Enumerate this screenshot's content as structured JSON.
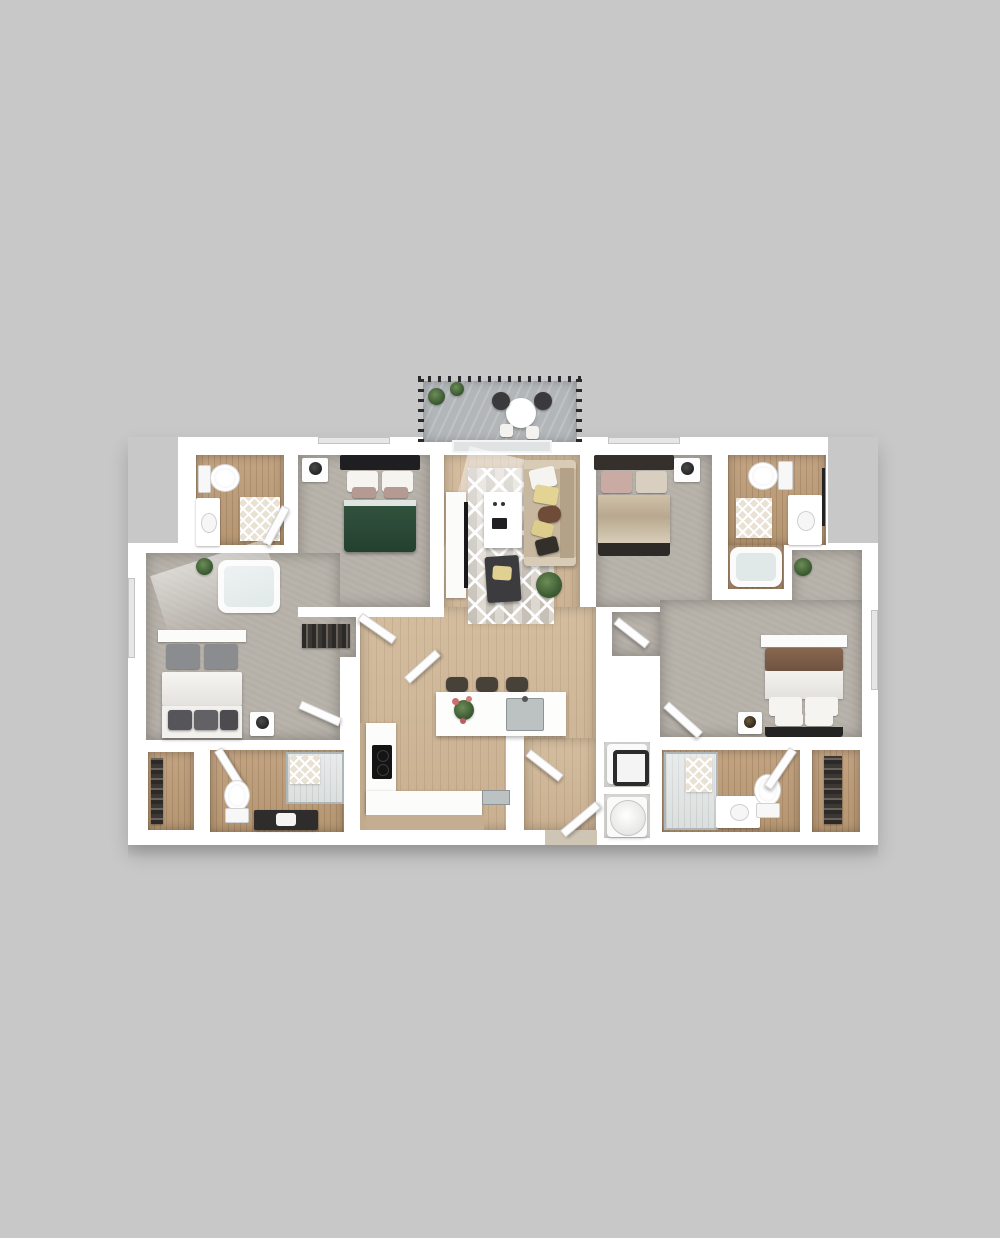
{
  "scene": {
    "type": "3d-floor-plan-render",
    "description": "Top-down 3D architectural rendering of a four-bedroom, four-bathroom apartment floor plan with a central living room and kitchen, a top balcony with patio furniture, and a stacked washer/dryer closet. No text labels are present in the image.",
    "background_color": "#c8c8c8",
    "wall_color": "#ffffff"
  },
  "palette": {
    "background": "#c8c8c8",
    "walls": "#ffffff",
    "carpet": "#b4afa7",
    "wood_light": "#cdb698",
    "wood_bath": "#bc9d7c",
    "balcony_deck": "#b2b6b9",
    "railing": "#2b2b2d",
    "bed_green": "#2c4b3c",
    "bed_tan": "#d3c7b2",
    "blanket_brown": "#7c5c49",
    "sofa_tan": "#c7b89f",
    "accent_yellow": "#e3d494",
    "charcoal": "#2a2a2c",
    "plant_green": "#3f6136",
    "steel": "#bcc1c2"
  },
  "rooms": [
    {
      "name": "balcony",
      "floor": "gray deck planks",
      "furniture": [
        "round patio table",
        "two dark chairs",
        "two white stools",
        "two potted plants",
        "dark metal railing"
      ]
    },
    {
      "name": "bathroom-top-left",
      "floor": "wood",
      "furniture": [
        "toilet",
        "vanity with sink",
        "lattice bath mat",
        "bathtub in nook"
      ]
    },
    {
      "name": "bedroom-top-left",
      "floor": "carpet",
      "furniture": [
        "bed with dark headboard and green duvet",
        "white pillows",
        "nightstand with lamp"
      ]
    },
    {
      "name": "living-room",
      "floor": "wood",
      "furniture": [
        "diamond pattern rug",
        "white media console with TV",
        "white coffee table",
        "tan sofa with pillows",
        "dark armchair with yellow pillow",
        "potted plant",
        "balcony glass door"
      ]
    },
    {
      "name": "bedroom-top-right",
      "floor": "carpet",
      "furniture": [
        "bed with dark headboard and cream duvet",
        "blush and cream pillows",
        "nightstand with black lamp"
      ]
    },
    {
      "name": "bathroom-top-right",
      "floor": "wood",
      "furniture": [
        "toilet",
        "white vanity",
        "lattice bath mat",
        "bathtub in nook",
        "black towel bar"
      ]
    },
    {
      "name": "bedroom-left",
      "floor": "carpet",
      "furniture": [
        "white bed with gray pillows",
        "foot bench with dark cushions",
        "nightstand with black lamp",
        "potted plant",
        "window light shaft"
      ]
    },
    {
      "name": "bedroom-right",
      "floor": "carpet",
      "furniture": [
        "bed with dark headboard, white duvet and brown blanket",
        "white pillows",
        "nightstand with lamp",
        "potted plant in entry nook"
      ]
    },
    {
      "name": "kitchen",
      "floor": "wood",
      "furniture": [
        "white island with steel sink and flowers",
        "three dark bar stools",
        "L-shaped counter with black cooktop",
        "steel dishwasher strip",
        "beige lower cabinet strip"
      ]
    },
    {
      "name": "entry-hall",
      "floor": "wood",
      "furniture": [
        "entry door ajar",
        "closet door ajar",
        "threshold"
      ]
    },
    {
      "name": "laundry-closet",
      "floor": "white",
      "furniture": [
        "stacked washer",
        "stacked dryer"
      ]
    },
    {
      "name": "bathroom-bottom-left",
      "floor": "wood",
      "furniture": [
        "door ajar",
        "toilet",
        "glass shower with lattice tile",
        "dark vanity with white sink"
      ]
    },
    {
      "name": "bathroom-bottom-right",
      "floor": "wood",
      "furniture": [
        "glass shower with lattice tile",
        "white vanity with sink",
        "toilet",
        "door ajar"
      ]
    },
    {
      "name": "closet-bottom-left",
      "floor": "wood",
      "furniture": [
        "shelving with folded items"
      ]
    },
    {
      "name": "closet-bottom-right",
      "floor": "wood",
      "furniture": [
        "hanging clothes rod"
      ]
    },
    {
      "name": "walk-in-closet-center",
      "floor": "carpet",
      "furniture": [
        "hanging clothes",
        "open closet doors"
      ]
    }
  ]
}
